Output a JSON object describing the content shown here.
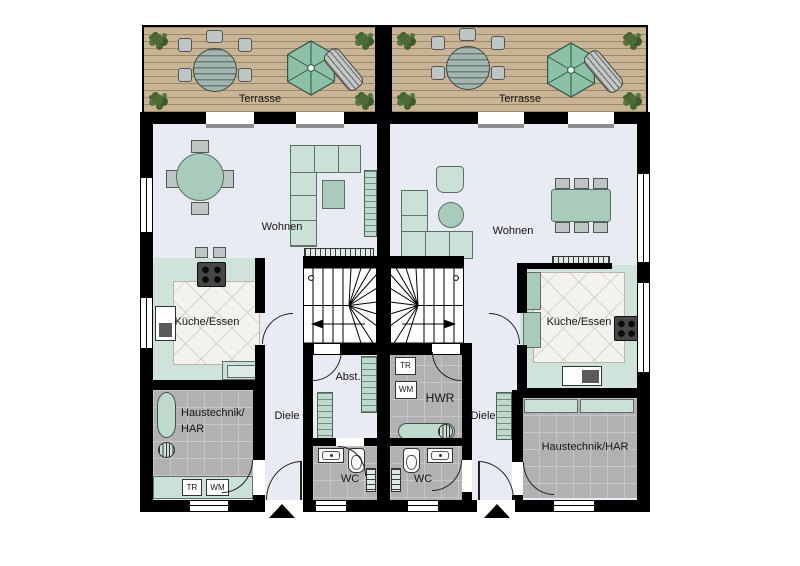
{
  "colors": {
    "wall": "#000000",
    "living_floor": "#e9ebf2",
    "kitchen_floor": "#cfe3da",
    "gray_tile": "#b3b0b4",
    "deck_wood": "#c9b595",
    "furniture_mint": "#cbe0d6",
    "umbrella_green": "#8cc0a7",
    "plant_green": "#4c6b35"
  },
  "units": {
    "left": {
      "terrace": "Terrasse",
      "living": "Wohnen",
      "kitchen": "Küche/Essen",
      "utility_line1": "Haustechnik/",
      "utility_line2": "HAR",
      "hall": "Diele",
      "storage": "Abst.",
      "wc": "WC",
      "dryer": "TR",
      "washer": "WM"
    },
    "right": {
      "terrace": "Terrasse",
      "living": "Wohnen",
      "kitchen": "Küche/Essen",
      "utility": "Haustechnik/HAR",
      "hall": "Diele",
      "laundry": "HWR",
      "wc": "WC",
      "dryer": "TR",
      "washer": "WM"
    }
  }
}
